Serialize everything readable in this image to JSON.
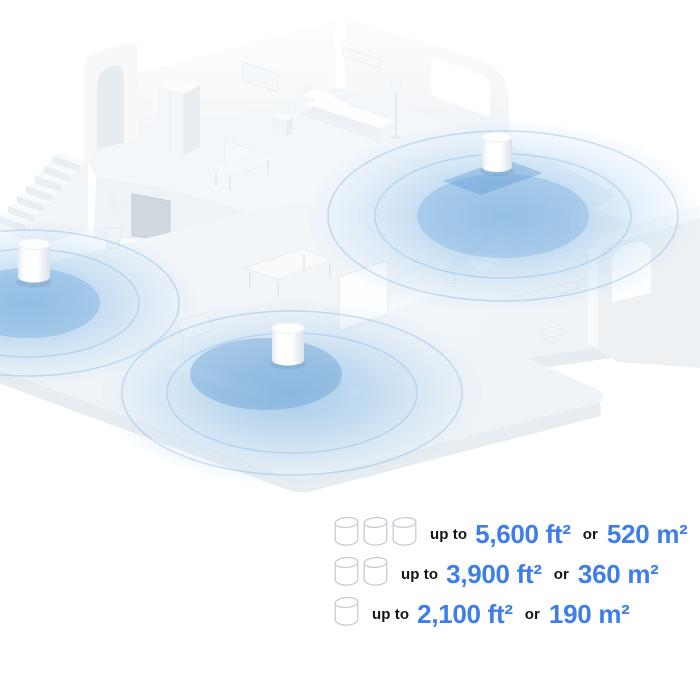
{
  "illustration": {
    "name": "isometric-home-mesh-wifi-coverage",
    "router_count": 3,
    "coverage_color": "#8fbee8",
    "coverage_inner_color": "#6fa8dc",
    "floor_color": "#f2f5f8",
    "wall_color": "#fbfcfd"
  },
  "legend": {
    "accent_blue": "#3d7ee9",
    "text_dark": "#141414",
    "rows": [
      {
        "units": 3,
        "prefix": "up to",
        "imperial": "5,600 ft²",
        "conj": "or",
        "metric": "520 m²"
      },
      {
        "units": 2,
        "prefix": "up to",
        "imperial": "3,900 ft²",
        "conj": "or",
        "metric": "360 m²"
      },
      {
        "units": 1,
        "prefix": "up to",
        "imperial": "2,100 ft²",
        "conj": "or",
        "metric": "190 m²"
      }
    ]
  }
}
